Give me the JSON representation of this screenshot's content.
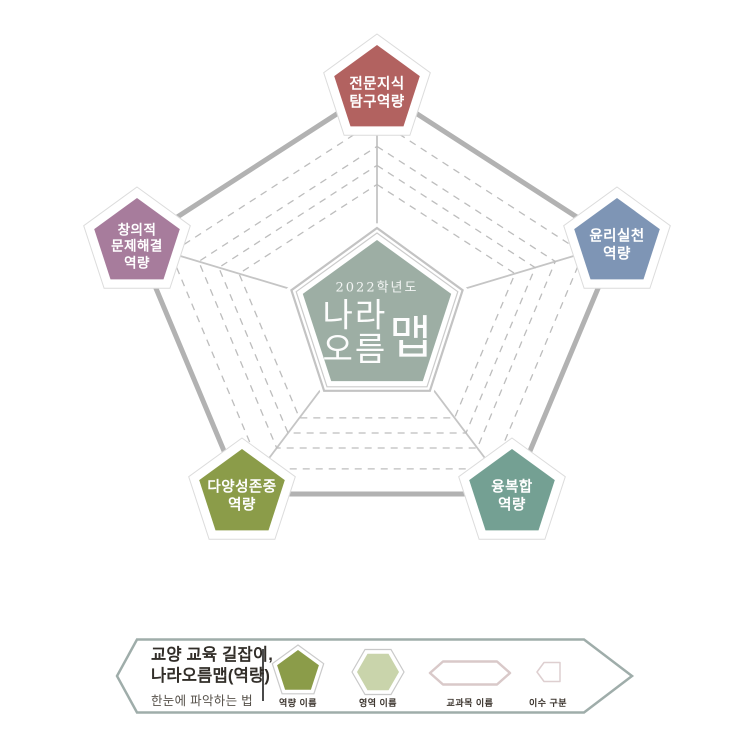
{
  "radar": {
    "center": {
      "year": "2022학년도",
      "title_stack": "나라\n오름",
      "title_side": "맵",
      "fill": "#9daea4"
    },
    "nodes": [
      {
        "id": "professional-knowledge",
        "label": "전문지식\n탐구역량",
        "fill": "#b26260"
      },
      {
        "id": "ethics-practice",
        "label": "윤리실천\n역량",
        "fill": "#7e95b5"
      },
      {
        "id": "convergence",
        "label": "융복합\n역량",
        "fill": "#74a093"
      },
      {
        "id": "diversity-respect",
        "label": "다양성존중\n역량",
        "fill": "#8b9c49"
      },
      {
        "id": "creative-problem-solving",
        "label": "창의적\n문제해결\n역량",
        "fill": "#a77c9c"
      }
    ]
  },
  "legend": {
    "heading_line1": "교양 교육 길잡이,",
    "heading_line2": "나라오름맵(역량)",
    "heading_line3": "한눈에 파악하는 법",
    "border_color": "#9fadaa",
    "items": [
      {
        "label": "역량 이름",
        "fill": "#8b9c49"
      },
      {
        "label": "영역 이름",
        "fill": "#c9d4ab"
      },
      {
        "label": "교과목 이름",
        "stroke": "#d9c9c9"
      },
      {
        "label": "이수 구분",
        "stroke": "#decfd0"
      }
    ]
  }
}
